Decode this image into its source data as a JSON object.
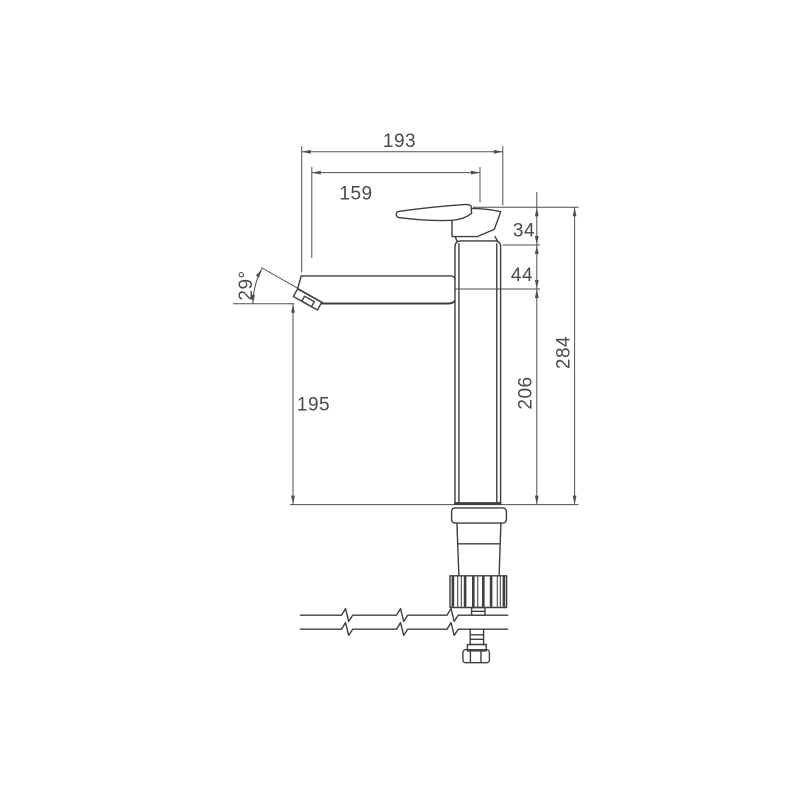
{
  "drawing": {
    "kind": "technical-dimension-drawing",
    "colors": {
      "object_line": "#3f3f3f",
      "dimension_line": "#4f4f4f",
      "text": "#4a4a4a",
      "background": "#ffffff"
    },
    "dims": {
      "d193": "193",
      "d159": "159",
      "d34": "34",
      "d44": "44",
      "d284": "284",
      "d206": "206",
      "d195": "195",
      "angle29": "29°"
    }
  }
}
